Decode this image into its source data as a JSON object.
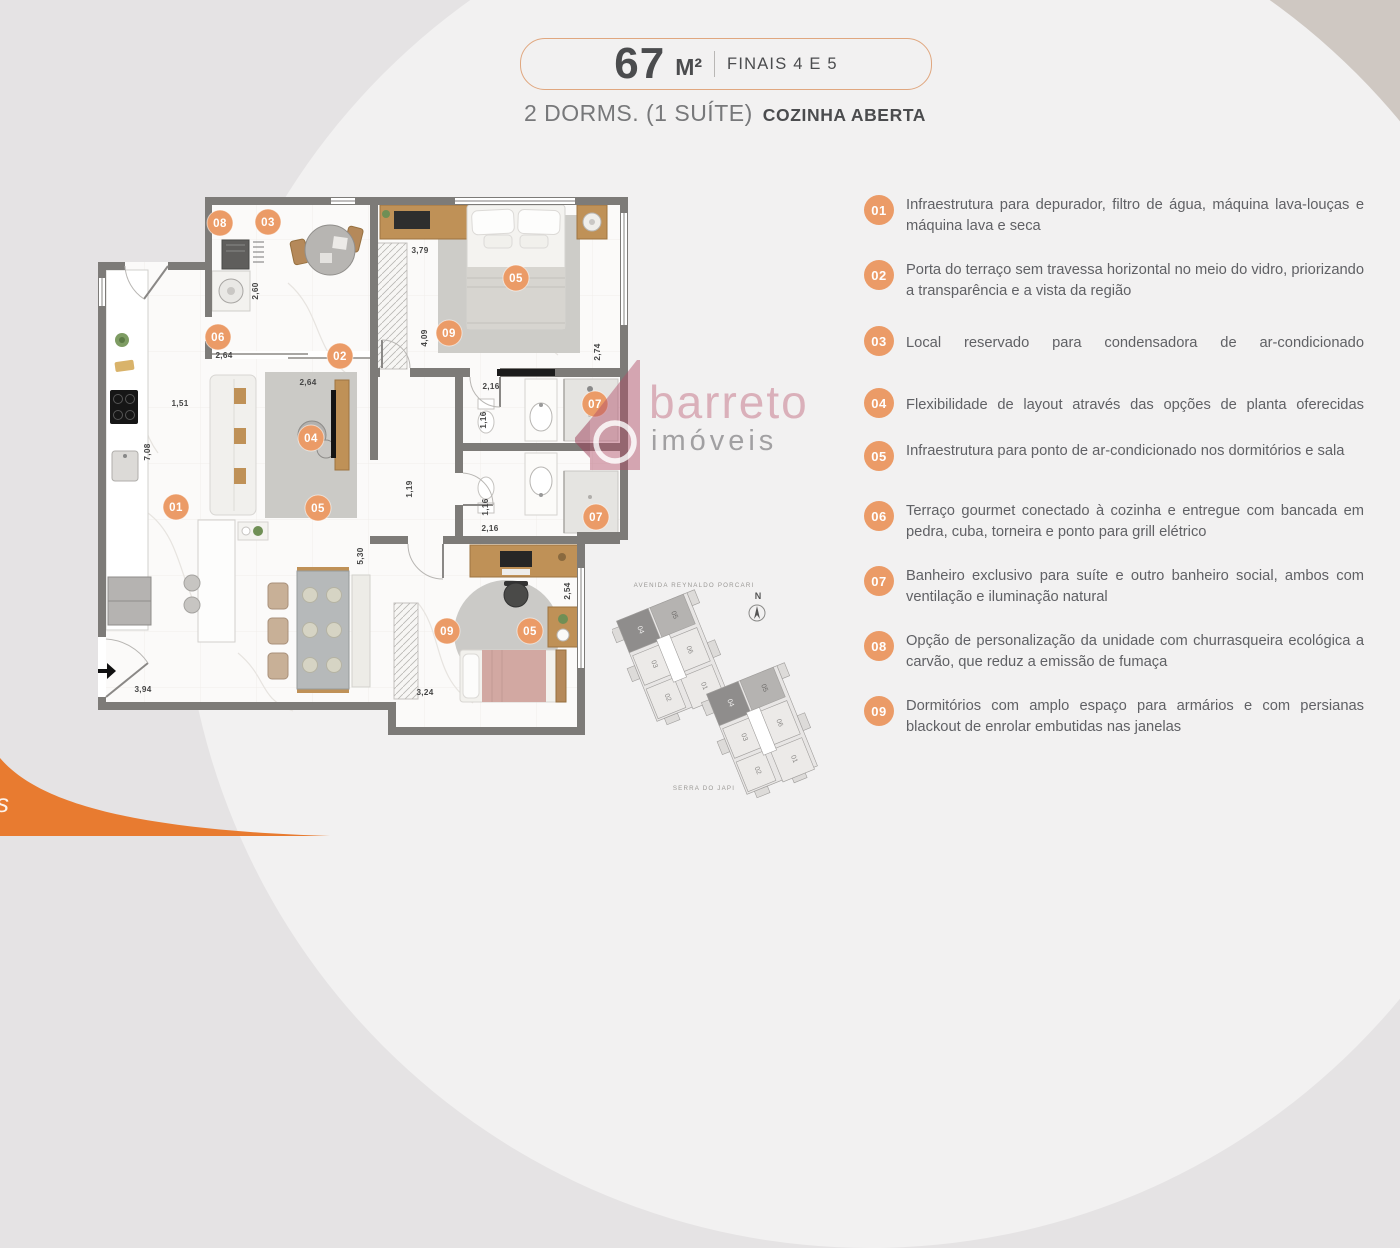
{
  "header": {
    "area_value": "67",
    "area_unit": "M²",
    "finals": "FINAIS 4 E 5",
    "subtitle_regular": "2 DORMS. (1 SUÍTE)",
    "subtitle_bold": "COZINHA ABERTA"
  },
  "features": [
    {
      "num": "01",
      "text": "Infraestrutura para depurador, filtro de água, máquina lava-louças e máquina lava e seca"
    },
    {
      "num": "02",
      "text": "Porta do terraço sem travessa horizontal no meio do vidro, priorizando a transparência e a vista da região"
    },
    {
      "num": "03",
      "text": "Local reservado para condensadora de ar-condicionado"
    },
    {
      "num": "04",
      "text": "Flexibilidade de layout através das opções de planta oferecidas"
    },
    {
      "num": "05",
      "text": "Infraestrutura para ponto de ar-condicionado nos dormitórios e sala"
    },
    {
      "num": "06",
      "text": "Terraço gourmet conectado à cozinha e entregue com bancada em pedra, cuba, torneira e ponto para grill elétrico"
    },
    {
      "num": "07",
      "text": "Banheiro exclusivo para suíte e outro banheiro social, ambos com ventilação e iluminação natural"
    },
    {
      "num": "08",
      "text": "Opção de personalização da unidade com churrasqueira ecológica a carvão, que reduz a emissão de fumaça"
    },
    {
      "num": "09",
      "text": "Dormitórios com amplo espaço para armários e com persianas blackout de enrolar embutidas nas janelas"
    }
  ],
  "floorplan": {
    "badges": [
      {
        "n": "08",
        "x": 220,
        "y": 223
      },
      {
        "n": "03",
        "x": 268,
        "y": 222
      },
      {
        "n": "06",
        "x": 218,
        "y": 337
      },
      {
        "n": "02",
        "x": 340,
        "y": 356
      },
      {
        "n": "04",
        "x": 311,
        "y": 438
      },
      {
        "n": "05",
        "x": 318,
        "y": 508
      },
      {
        "n": "01",
        "x": 176,
        "y": 507
      },
      {
        "n": "05",
        "x": 516,
        "y": 278
      },
      {
        "n": "09",
        "x": 449,
        "y": 333
      },
      {
        "n": "07",
        "x": 595,
        "y": 404
      },
      {
        "n": "07",
        "x": 596,
        "y": 517
      },
      {
        "n": "09",
        "x": 447,
        "y": 631
      },
      {
        "n": "05",
        "x": 530,
        "y": 631
      }
    ],
    "dimensions": [
      {
        "v": "3,79",
        "x": 420,
        "y": 253,
        "r": 0
      },
      {
        "v": "4,09",
        "x": 427,
        "y": 338,
        "r": 90
      },
      {
        "v": "2,74",
        "x": 600,
        "y": 352,
        "r": 90
      },
      {
        "v": "2,60",
        "x": 258,
        "y": 291,
        "r": 90
      },
      {
        "v": "2,64",
        "x": 224,
        "y": 358,
        "r": 0
      },
      {
        "v": "2,64",
        "x": 308,
        "y": 385,
        "r": 0
      },
      {
        "v": "1,51",
        "x": 180,
        "y": 406,
        "r": 0
      },
      {
        "v": "7,08",
        "x": 150,
        "y": 452,
        "r": 90
      },
      {
        "v": "2,16",
        "x": 491,
        "y": 389,
        "r": 0
      },
      {
        "v": "1,16",
        "x": 486,
        "y": 420,
        "r": 90
      },
      {
        "v": "1,16",
        "x": 488,
        "y": 507,
        "r": 90
      },
      {
        "v": "2,16",
        "x": 490,
        "y": 531,
        "r": 0
      },
      {
        "v": "1,19",
        "x": 412,
        "y": 489,
        "r": 90
      },
      {
        "v": "5,30",
        "x": 363,
        "y": 556,
        "r": 90
      },
      {
        "v": "3,94",
        "x": 143,
        "y": 692,
        "r": 0
      },
      {
        "v": "3,24",
        "x": 425,
        "y": 695,
        "r": 0
      },
      {
        "v": "2,54",
        "x": 570,
        "y": 591,
        "r": 90
      }
    ]
  },
  "watermark": {
    "brand": "barreto",
    "brand2": "imóveis"
  },
  "keyplan": {
    "street_top": "AVENIDA REYNALDO PORCARI",
    "street_bottom": "SERRA DO JAPI",
    "compass": "N",
    "buildings": [
      {
        "units": [
          "04",
          "05",
          "03",
          "06",
          "02",
          "01"
        ]
      },
      {
        "units": [
          "04",
          "05",
          "03",
          "06",
          "02",
          "01"
        ]
      }
    ]
  },
  "decor": {
    "corner_fragment": "s"
  },
  "colors": {
    "accent_orange": "#eb9b67",
    "corner_orange": "#e87b30",
    "brand_pink": "#b24e68",
    "text_dark": "#4b4c4e",
    "text_gray": "#606165",
    "wall_gray": "#7d7b78"
  }
}
